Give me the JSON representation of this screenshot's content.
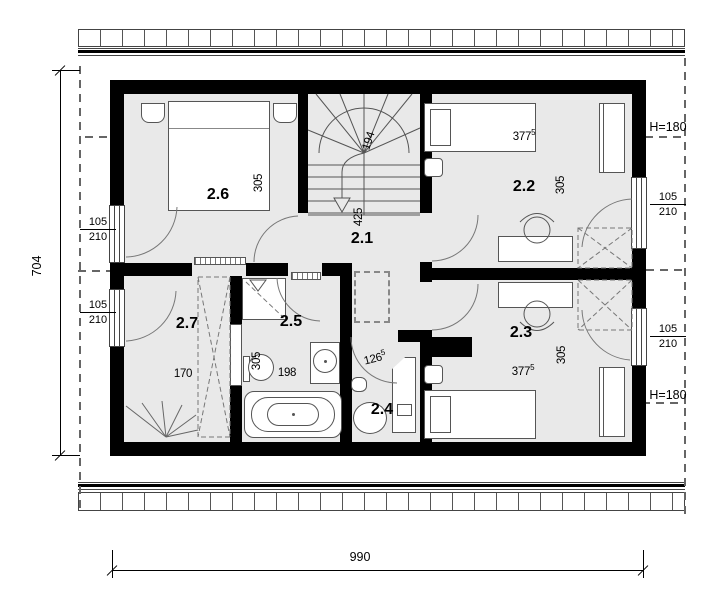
{
  "meta": {
    "drawing_type": "architectural floor plan"
  },
  "overall": {
    "width_cm": "990",
    "depth_cm": "704"
  },
  "rooms": {
    "hall": {
      "label": "2.1",
      "length": "425"
    },
    "bed1": {
      "label": "2.2",
      "width": "377",
      "width_sup": "5",
      "depth": "305"
    },
    "bed2": {
      "label": "2.3",
      "width": "377",
      "width_sup": "5",
      "depth": "305"
    },
    "wc": {
      "label": "2.4",
      "width": "126",
      "width_sup": "5"
    },
    "bath": {
      "label": "2.5",
      "width": "198",
      "depth": "305"
    },
    "bed3": {
      "label": "2.6",
      "depth": "305"
    },
    "dress": {
      "label": "2.7",
      "width": "170"
    }
  },
  "stairs": {
    "width": "194"
  },
  "window": {
    "width": "105",
    "height": "210"
  },
  "height_marks": {
    "upper": "H=180",
    "lower": "H=180"
  }
}
